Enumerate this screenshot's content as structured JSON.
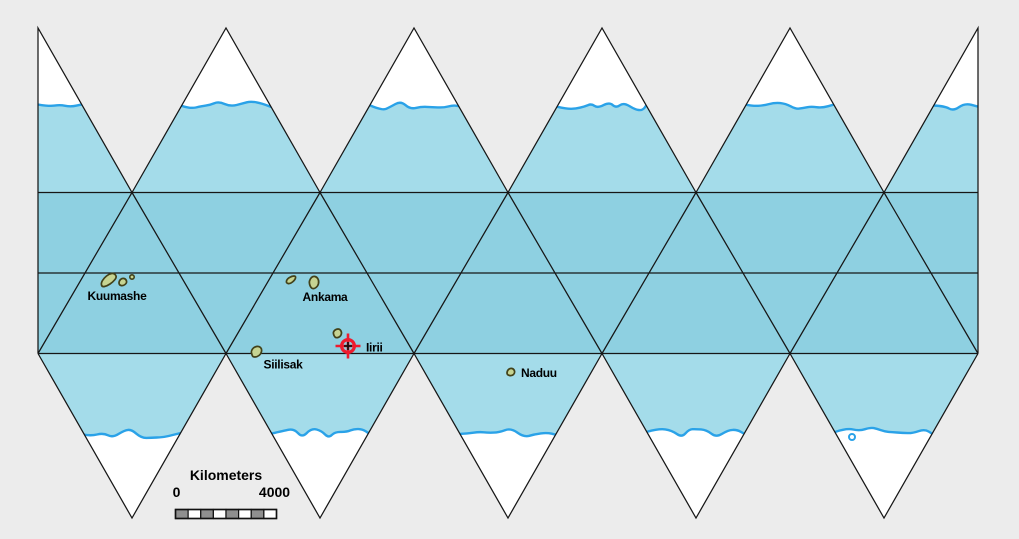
{
  "map": {
    "projection": "icosahedral-net-world-map",
    "colors": {
      "background": "#ececec",
      "ocean_outer": "#a4dcea",
      "ocean_band": "#8ed0e1",
      "polar_cap": "#ffffff",
      "coastline": "#2aa2e8",
      "net_line": "#161616",
      "island_fill": "#c6d492",
      "island_stroke": "#42421a",
      "marker_red": "#ee1b2e",
      "marker_black": "#101010",
      "label_color": "#000000"
    },
    "geometry": {
      "left": 38,
      "right": 978,
      "half_base": 94,
      "top_apex_y": 28,
      "band_top": 192.5,
      "equator_y": 273,
      "band_bottom": 353.5,
      "bottom_apex_y": 518,
      "top_apex_xs": [
        38,
        226,
        414,
        602,
        790,
        978
      ],
      "band_top_vertex_xs": [
        132,
        320,
        508,
        696,
        884
      ],
      "bottom_apex_xs": [
        132,
        320,
        508,
        696,
        884
      ],
      "top_coast_y": 106,
      "bottom_coast_y": 433
    },
    "islands": [
      {
        "name": "Kuumashe",
        "shape": "path",
        "points": [
          [
            102,
            287
          ],
          [
            101,
            283
          ],
          [
            104,
            278
          ],
          [
            109,
            274
          ],
          [
            114,
            273
          ],
          [
            117,
            277
          ],
          [
            113,
            282
          ],
          [
            107,
            286
          ]
        ]
      },
      {
        "name": "Kuumashe",
        "shape": "path",
        "points": [
          [
            119,
            285
          ],
          [
            119,
            281
          ],
          [
            122,
            278
          ],
          [
            126,
            279
          ],
          [
            127,
            283
          ],
          [
            123,
            286
          ]
        ]
      },
      {
        "name": "Kuumashe",
        "shape": "circle",
        "cx": 132,
        "cy": 277,
        "r": 2.2
      },
      {
        "name": "Ankama",
        "shape": "path",
        "points": [
          [
            286,
            283
          ],
          [
            287,
            279
          ],
          [
            292,
            276
          ],
          [
            296,
            276
          ],
          [
            295,
            280
          ],
          [
            290,
            284
          ]
        ]
      },
      {
        "name": "Ankama",
        "shape": "path",
        "points": [
          [
            311,
            288
          ],
          [
            309,
            283
          ],
          [
            310,
            279
          ],
          [
            313,
            276
          ],
          [
            317,
            277
          ],
          [
            319,
            281
          ],
          [
            318,
            286
          ],
          [
            314,
            289
          ]
        ]
      },
      {
        "name": "Siilisak",
        "shape": "path",
        "points": [
          [
            252,
            355
          ],
          [
            251,
            351
          ],
          [
            254,
            347
          ],
          [
            259,
            346
          ],
          [
            262,
            349
          ],
          [
            261,
            354
          ],
          [
            257,
            357
          ],
          [
            253,
            357
          ]
        ]
      },
      {
        "name": "Iirii",
        "shape": "path",
        "points": [
          [
            334,
            336
          ],
          [
            333,
            332
          ],
          [
            336,
            329
          ],
          [
            340,
            329
          ],
          [
            342,
            333
          ],
          [
            340,
            337
          ],
          [
            336,
            338
          ]
        ]
      },
      {
        "name": "Naduu",
        "shape": "path",
        "points": [
          [
            507,
            375
          ],
          [
            507,
            371
          ],
          [
            510,
            368
          ],
          [
            514,
            369
          ],
          [
            515,
            373
          ],
          [
            512,
            376
          ]
        ]
      }
    ],
    "atoll": {
      "cx": 852,
      "cy": 437,
      "r": 3
    },
    "labels": [
      {
        "text": "Kuumashe",
        "x": 117,
        "y": 300,
        "anchor": "middle"
      },
      {
        "text": "Ankama",
        "x": 325,
        "y": 301,
        "anchor": "middle"
      },
      {
        "text": "Siilisak",
        "x": 283,
        "y": 368.5,
        "anchor": "middle"
      },
      {
        "text": "Iirii",
        "x": 366,
        "y": 351.5,
        "anchor": "start"
      },
      {
        "text": "Naduu",
        "x": 521,
        "y": 377,
        "anchor": "start"
      }
    ],
    "marker": {
      "x": 348,
      "y": 346,
      "location": "Iirii"
    }
  },
  "scale_bar": {
    "title": "Kilometers",
    "start_label": "0",
    "end_label": "4000",
    "x": 175.5,
    "y": 509.5,
    "width": 101,
    "height": 9,
    "segments": 8,
    "title_x": 226,
    "title_y": 480,
    "tick_y": 497,
    "start_tick_x": 176.5,
    "end_tick_x": 274.5,
    "fill_dark": "#8f8f8f",
    "fill_light": "#ffffff",
    "outline": "#111111"
  }
}
